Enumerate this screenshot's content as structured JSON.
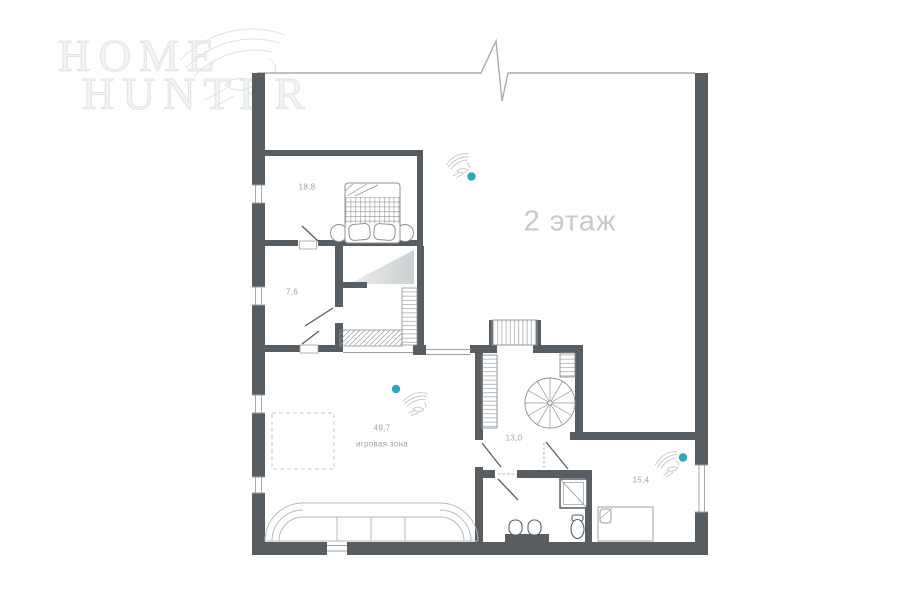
{
  "brand": {
    "name_line1": "HOME",
    "name_line2": "HUNTER"
  },
  "floor": {
    "title": "2 этаж"
  },
  "rooms": {
    "bedroom": {
      "area": "18,8"
    },
    "dressing": {
      "area": "7,6"
    },
    "playroom": {
      "area": "49,7",
      "name": "игровая зона"
    },
    "hall": {
      "area": "13,0"
    },
    "bedroom2": {
      "area": "15,4"
    }
  },
  "markers": {
    "photo_marker_count": 3
  },
  "colors": {
    "wall": "#585d62",
    "thin_line": "#9aa0a4",
    "furniture_line": "#8d9195",
    "sofa_line": "#b6babd",
    "label_text": "#9fa3a5",
    "floor_title_text": "#c7c9cb",
    "watermark": "#e8e9ea",
    "accent_dot": "#2aa7b8"
  }
}
